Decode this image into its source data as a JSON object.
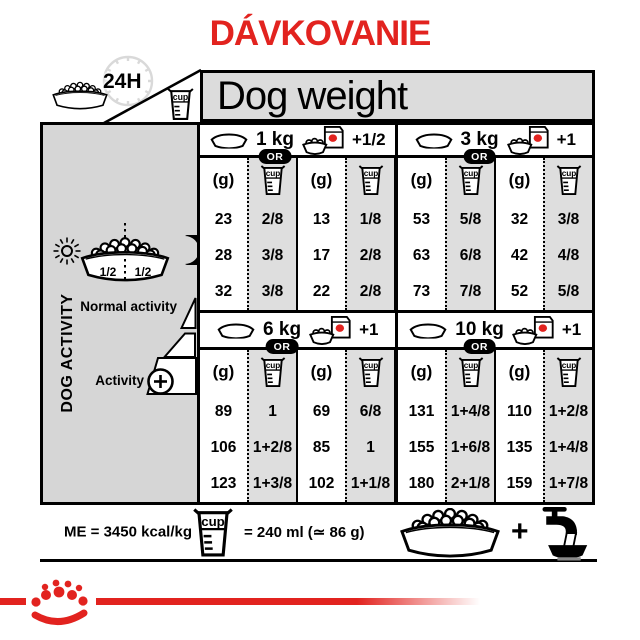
{
  "title": "DÁVKOVANIE",
  "header": {
    "dog_weight": "Dog weight",
    "daily": "24H"
  },
  "labels": {
    "cup": "cup",
    "grams": "(g)",
    "or": "OR"
  },
  "sections": [
    {
      "weight": "1 kg",
      "plus": "+1/2",
      "pairs": [
        {
          "g": [
            "23",
            "28",
            "32"
          ],
          "cup": [
            "2/8",
            "3/8",
            "3/8"
          ]
        },
        {
          "g": [
            "13",
            "17",
            "22"
          ],
          "cup": [
            "1/8",
            "2/8",
            "2/8"
          ]
        }
      ]
    },
    {
      "weight": "3 kg",
      "plus": "+1",
      "pairs": [
        {
          "g": [
            "53",
            "63",
            "73"
          ],
          "cup": [
            "5/8",
            "6/8",
            "7/8"
          ]
        },
        {
          "g": [
            "32",
            "42",
            "52"
          ],
          "cup": [
            "3/8",
            "4/8",
            "5/8"
          ]
        }
      ]
    },
    {
      "weight": "6 kg",
      "plus": "+1",
      "pairs": [
        {
          "g": [
            "89",
            "106",
            "123"
          ],
          "cup": [
            "1",
            "1+2/8",
            "1+3/8"
          ]
        },
        {
          "g": [
            "69",
            "85",
            "102"
          ],
          "cup": [
            "6/8",
            "1",
            "1+1/8"
          ]
        }
      ]
    },
    {
      "weight": "10 kg",
      "plus": "+1",
      "pairs": [
        {
          "g": [
            "131",
            "155",
            "180"
          ],
          "cup": [
            "1+4/8",
            "1+6/8",
            "2+1/8"
          ]
        },
        {
          "g": [
            "110",
            "135",
            "159"
          ],
          "cup": [
            "1+2/8",
            "1+4/8",
            "1+7/8"
          ]
        }
      ]
    }
  ],
  "sidebar": {
    "dog_activity": "DOG ACTIVITY",
    "normal": "Normal activity",
    "activity": "Activity",
    "half_left": "1/2",
    "half_right": "1/2"
  },
  "footer": {
    "me": "ME = 3450 kcal/kg",
    "cup_equiv": "= 240 ml (≃ 86 g)",
    "plus": "+"
  },
  "colors": {
    "accent_red": "#e2231f",
    "header_gray": "#dcdcdc",
    "cup_col_gray": "#dedede"
  },
  "icons": [
    "kibble-bowl-icon",
    "clock-icon",
    "measuring-cup-icon",
    "dry-food-bowl-icon",
    "wet-food-pouch-icon",
    "sun-icon",
    "moon-icon",
    "activity-ramp-icon",
    "plus-circle-icon",
    "tap-water-icon",
    "crown-logo"
  ]
}
